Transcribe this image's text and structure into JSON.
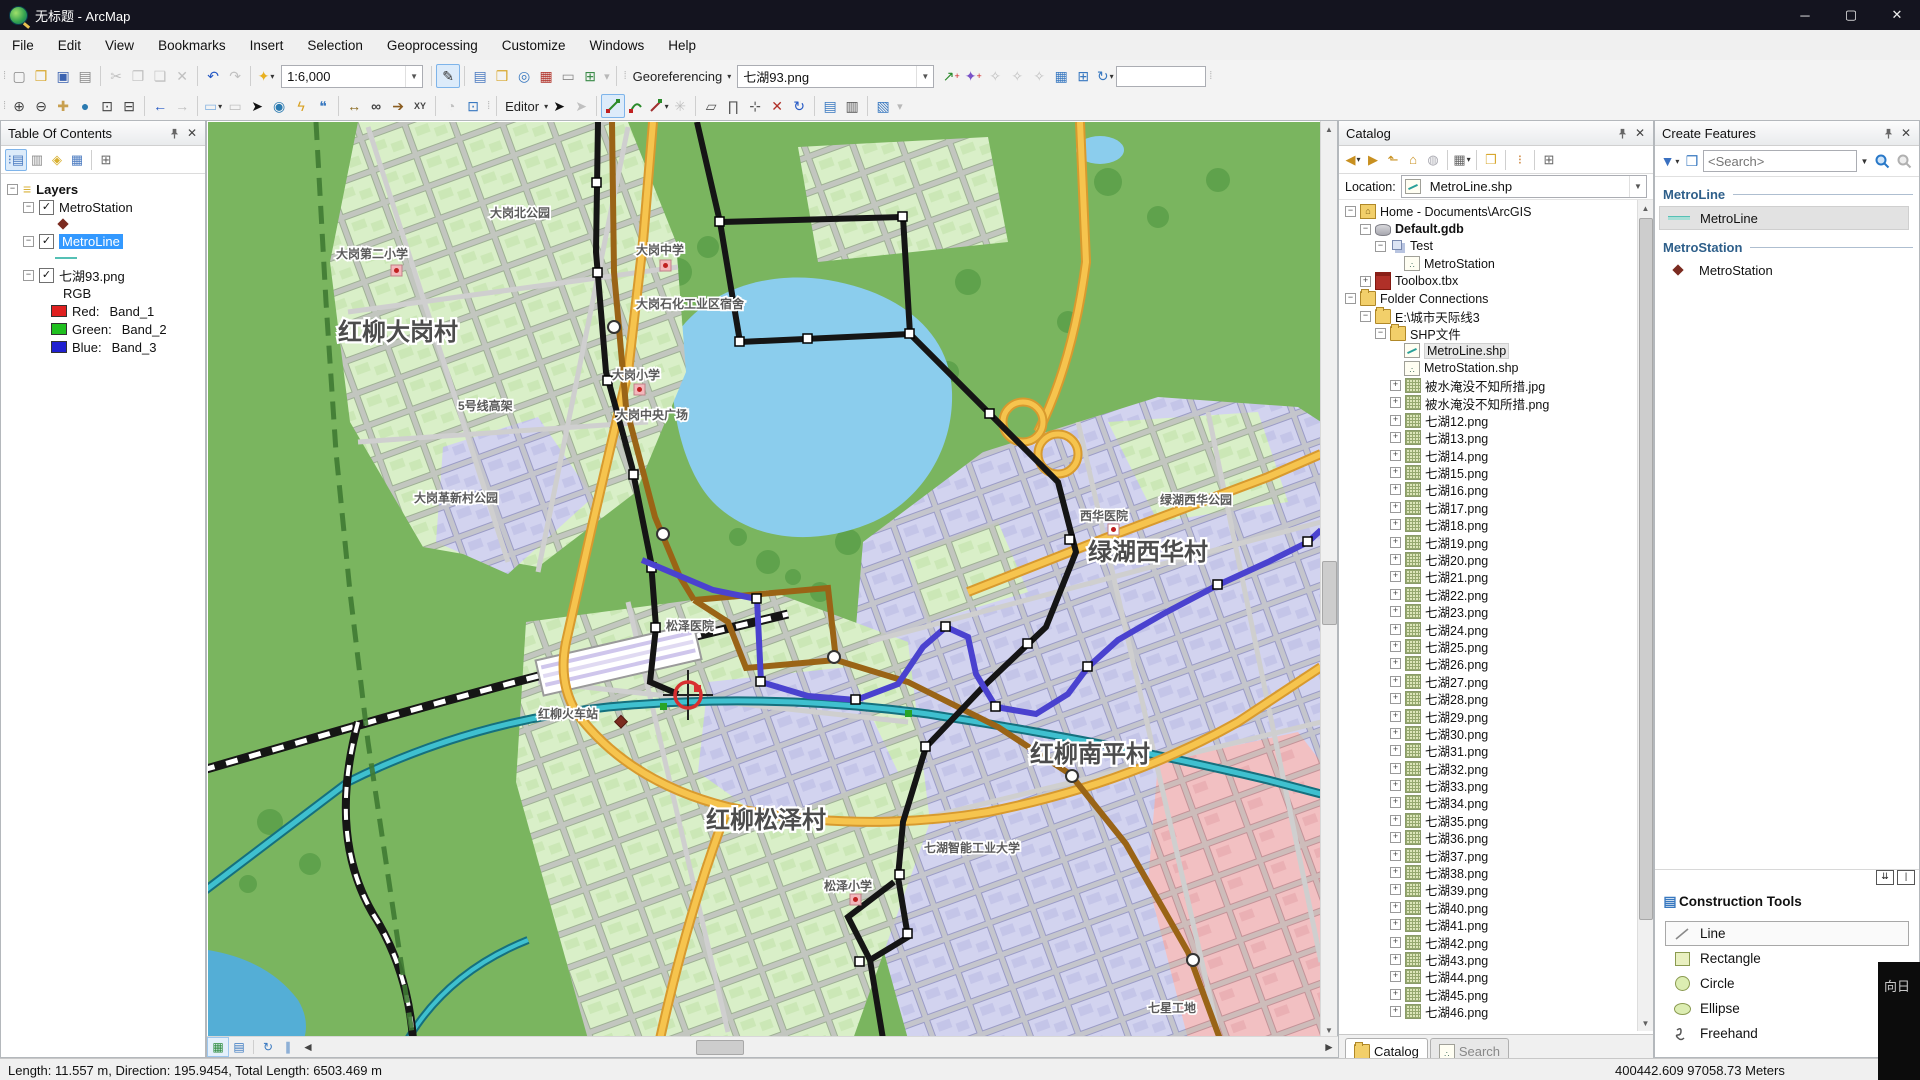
{
  "window": {
    "title": "无标题 - ArcMap"
  },
  "menu": {
    "items": [
      "File",
      "Edit",
      "View",
      "Bookmarks",
      "Insert",
      "Selection",
      "Geoprocessing",
      "Customize",
      "Windows",
      "Help"
    ]
  },
  "toolbar": {
    "scale_value": "1:6,000",
    "georeferencing_label": "Georeferencing",
    "georeferencing_file": "七湖93.png",
    "editor_label": "Editor",
    "rotation_value": ""
  },
  "colors": {
    "accent": "#3399ff",
    "metroline_symbol": "#55c0b5",
    "metrostation_symbol": "#7b2b20",
    "selection_blue": "#4a42cf"
  },
  "toc": {
    "title": "Table Of Contents",
    "layers_label": "Layers",
    "layer1": "MetroStation",
    "layer2": "MetroLine",
    "layer3": "七湖93.png",
    "rgb_label": "RGB",
    "band_rows": [
      {
        "name": "Red:",
        "band": "Band_1",
        "color": "#e02020"
      },
      {
        "name": "Green:",
        "band": "Band_2",
        "color": "#20c020"
      },
      {
        "name": "Blue:",
        "band": "Band_3",
        "color": "#2020d0"
      }
    ]
  },
  "catalog": {
    "title": "Catalog",
    "location_label": "Location:",
    "location_value": "MetroLine.shp",
    "rows": [
      {
        "d": 0,
        "i": "home",
        "t": "Home - Documents\\ArcGIS",
        "e": "-"
      },
      {
        "d": 1,
        "i": "gdb",
        "t": "Default.gdb",
        "e": "-",
        "b": true
      },
      {
        "d": 2,
        "i": "ds",
        "t": "Test",
        "e": "-"
      },
      {
        "d": 3,
        "i": "pt",
        "t": "MetroStation",
        "e": ""
      },
      {
        "d": 1,
        "i": "tbx",
        "t": "Toolbox.tbx",
        "e": "+"
      },
      {
        "d": 0,
        "i": "folder",
        "t": "Folder Connections",
        "e": "-"
      },
      {
        "d": 1,
        "i": "folder",
        "t": "E:\\城市天际线3",
        "e": "-"
      },
      {
        "d": 2,
        "i": "folder",
        "t": "SHP文件",
        "e": "-"
      },
      {
        "d": 3,
        "i": "shp-ln",
        "t": "MetroLine.shp",
        "e": "",
        "sel": true
      },
      {
        "d": 3,
        "i": "shp-pt",
        "t": "MetroStation.shp",
        "e": ""
      },
      {
        "d": 3,
        "i": "raster",
        "t": "被水淹没不知所措.jpg",
        "e": "+"
      },
      {
        "d": 3,
        "i": "raster",
        "t": "被水淹没不知所措.png",
        "e": "+"
      },
      {
        "d": 3,
        "i": "raster",
        "t": "七湖12.png",
        "e": "+"
      },
      {
        "d": 3,
        "i": "raster",
        "t": "七湖13.png",
        "e": "+"
      },
      {
        "d": 3,
        "i": "raster",
        "t": "七湖14.png",
        "e": "+"
      },
      {
        "d": 3,
        "i": "raster",
        "t": "七湖15.png",
        "e": "+"
      },
      {
        "d": 3,
        "i": "raster",
        "t": "七湖16.png",
        "e": "+"
      },
      {
        "d": 3,
        "i": "raster",
        "t": "七湖17.png",
        "e": "+"
      },
      {
        "d": 3,
        "i": "raster",
        "t": "七湖18.png",
        "e": "+"
      },
      {
        "d": 3,
        "i": "raster",
        "t": "七湖19.png",
        "e": "+"
      },
      {
        "d": 3,
        "i": "raster",
        "t": "七湖20.png",
        "e": "+"
      },
      {
        "d": 3,
        "i": "raster",
        "t": "七湖21.png",
        "e": "+"
      },
      {
        "d": 3,
        "i": "raster",
        "t": "七湖22.png",
        "e": "+"
      },
      {
        "d": 3,
        "i": "raster",
        "t": "七湖23.png",
        "e": "+"
      },
      {
        "d": 3,
        "i": "raster",
        "t": "七湖24.png",
        "e": "+"
      },
      {
        "d": 3,
        "i": "raster",
        "t": "七湖25.png",
        "e": "+"
      },
      {
        "d": 3,
        "i": "raster",
        "t": "七湖26.png",
        "e": "+"
      },
      {
        "d": 3,
        "i": "raster",
        "t": "七湖27.png",
        "e": "+"
      },
      {
        "d": 3,
        "i": "raster",
        "t": "七湖28.png",
        "e": "+"
      },
      {
        "d": 3,
        "i": "raster",
        "t": "七湖29.png",
        "e": "+"
      },
      {
        "d": 3,
        "i": "raster",
        "t": "七湖30.png",
        "e": "+"
      },
      {
        "d": 3,
        "i": "raster",
        "t": "七湖31.png",
        "e": "+"
      },
      {
        "d": 3,
        "i": "raster",
        "t": "七湖32.png",
        "e": "+"
      },
      {
        "d": 3,
        "i": "raster",
        "t": "七湖33.png",
        "e": "+"
      },
      {
        "d": 3,
        "i": "raster",
        "t": "七湖34.png",
        "e": "+"
      },
      {
        "d": 3,
        "i": "raster",
        "t": "七湖35.png",
        "e": "+"
      },
      {
        "d": 3,
        "i": "raster",
        "t": "七湖36.png",
        "e": "+"
      },
      {
        "d": 3,
        "i": "raster",
        "t": "七湖37.png",
        "e": "+"
      },
      {
        "d": 3,
        "i": "raster",
        "t": "七湖38.png",
        "e": "+"
      },
      {
        "d": 3,
        "i": "raster",
        "t": "七湖39.png",
        "e": "+"
      },
      {
        "d": 3,
        "i": "raster",
        "t": "七湖40.png",
        "e": "+"
      },
      {
        "d": 3,
        "i": "raster",
        "t": "七湖41.png",
        "e": "+"
      },
      {
        "d": 3,
        "i": "raster",
        "t": "七湖42.png",
        "e": "+"
      },
      {
        "d": 3,
        "i": "raster",
        "t": "七湖43.png",
        "e": "+"
      },
      {
        "d": 3,
        "i": "raster",
        "t": "七湖44.png",
        "e": "+"
      },
      {
        "d": 3,
        "i": "raster",
        "t": "七湖45.png",
        "e": "+"
      },
      {
        "d": 3,
        "i": "raster",
        "t": "七湖46.png",
        "e": "+"
      }
    ],
    "tabs": [
      {
        "label": "Catalog",
        "active": true
      },
      {
        "label": "Search",
        "active": false
      }
    ]
  },
  "create_features": {
    "title": "Create Features",
    "search_placeholder": "<Search>",
    "groups": [
      {
        "header": "MetroLine",
        "items": [
          {
            "label": "MetroLine",
            "sym": "line",
            "sel": true
          }
        ]
      },
      {
        "header": "MetroStation",
        "items": [
          {
            "label": "MetroStation",
            "sym": "point",
            "sel": false
          }
        ]
      }
    ]
  },
  "construction_tools": {
    "title": "Construction Tools",
    "tools": [
      {
        "label": "Line",
        "sym": "line",
        "sel": true
      },
      {
        "label": "Rectangle",
        "sym": "rect",
        "sel": false
      },
      {
        "label": "Circle",
        "sym": "circle",
        "sel": false
      },
      {
        "label": "Ellipse",
        "sym": "ellipse",
        "sel": false
      },
      {
        "label": "Freehand",
        "sym": "freehand",
        "sel": false
      }
    ]
  },
  "status_bar": {
    "left": "Length: 11.557 m, Direction: 195.9454, Total Length: 6503.469 m",
    "coordinates": "400442.609  97058.73 Meters"
  },
  "overlay": {
    "text": "向日"
  },
  "map": {
    "major": [
      {
        "t": "红柳大岗村"
      },
      {
        "t": "绿湖西华村"
      },
      {
        "t": "红柳南平村"
      },
      {
        "t": "红柳松泽村"
      }
    ],
    "minor": [
      {
        "t": "大岗北公园"
      },
      {
        "t": "大岗第二小学"
      },
      {
        "t": "大岗中学"
      },
      {
        "t": "大岗石化工业区宿舍"
      },
      {
        "t": "大岗小学"
      },
      {
        "t": "大岗中央广场"
      },
      {
        "t": "大岗革新村公园"
      },
      {
        "t": "5号线高架"
      },
      {
        "t": "红柳火车站"
      },
      {
        "t": "松泽医院"
      },
      {
        "t": "西华医院"
      },
      {
        "t": "绿湖西华公园"
      },
      {
        "t": "七湖智能工业大学"
      },
      {
        "t": "松泽小学"
      },
      {
        "t": "七星工地"
      }
    ]
  }
}
